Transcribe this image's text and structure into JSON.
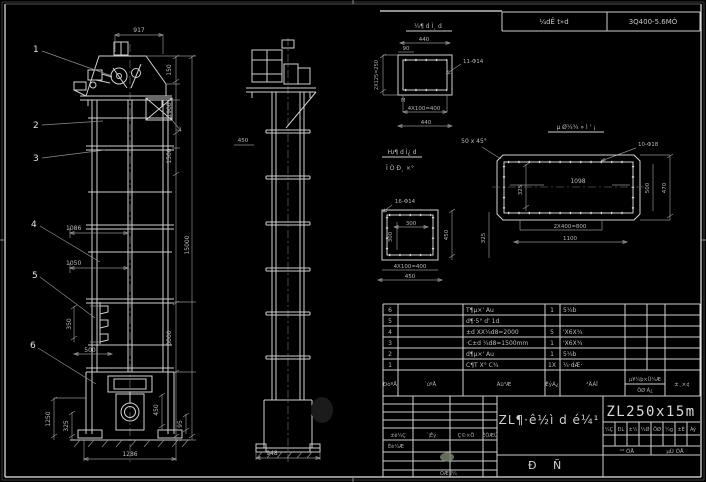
{
  "colors": {
    "background": "#000000",
    "line": "#cfcfcf",
    "dim_text": "#aeaeae",
    "stamp": "#76806b"
  },
  "frame": {
    "band_left": "¼dÊ t»d",
    "band_right": "3Q400-5.6MÓ"
  },
  "front_view": {
    "balloons": [
      "1",
      "2",
      "3",
      "4",
      "5",
      "6"
    ],
    "dims": {
      "top_width": "917",
      "v150": "150",
      "v1900": "1900",
      "v1500": "1500",
      "v15000": "15000",
      "v3000": "3000",
      "v350": "350",
      "h1086": "1086",
      "h1050": "1050",
      "h500": "500",
      "v1250": "1250",
      "v325": "325",
      "v450": "450",
      "v95": "95",
      "bottom_width": "1286"
    }
  },
  "side_view": {
    "dims": {
      "d450": "450",
      "bottom_width": "948"
    }
  },
  "detail_flange": {
    "title": "¼¶ d Ì¸ d",
    "dim_440": "440",
    "dim_90": "90",
    "holes": "11-Φ14",
    "dim_2x125": "2X125=250",
    "dim_4x100": "4X100=400",
    "dim_440b": "440",
    "weld": "M"
  },
  "note_chamfer": "50 x 45°",
  "detail_square": {
    "title_top": "Ƕ¶ d Ì¿ d",
    "title_bottom": "Î Ò Ð¸ ×°",
    "holes": "16-Φ14",
    "dim_300h": "300",
    "dim_300v": "300",
    "dim_4x100": "4X100=400",
    "dim_450": "450",
    "dim_450r": "450",
    "dim_325": "325"
  },
  "detail_base": {
    "title": "µ Ø¼¾ » ì ' ¡",
    "holes": "10-Φ18",
    "dim_1098": "1098",
    "dim_325": "325",
    "dim_2x400": "2X400=800",
    "dim_1100": "1100",
    "dim_500": "500",
    "dim_470": "470"
  },
  "bom": {
    "headers": {
      "no": "ÐòºÅ",
      "code": "´úºÅ",
      "name": "Ãû³Æ",
      "qty": "ÊýÁ¿",
      "mat": "²ÄÁÏ",
      "weight_top": "µ¥¼þ×Ü¼Æ",
      "weight_bottom": "ÖØ Á¿",
      "note": "±¸×¢"
    },
    "rows": [
      {
        "no": "6",
        "name": "T¶µ×' Au",
        "qty": "1",
        "mat": "5¼b"
      },
      {
        "no": "5",
        "name": "d¶·5° d' 1d",
        "qty": "",
        "mat": ""
      },
      {
        "no": "4",
        "name": "±d XX¼d8=2000",
        "qty": "5",
        "mat": "'X6X¾"
      },
      {
        "no": "3",
        "name": "·C±d ¼d8=1500mm",
        "qty": "1",
        "mat": "'X6X¾"
      },
      {
        "no": "2",
        "name": "d¶µ×' Au",
        "qty": "1",
        "mat": "5¼b"
      },
      {
        "no": "1",
        "name": "C¶T X° C¾",
        "qty": "1X",
        "mat": "¼·dÆ·"
      }
    ]
  },
  "title_block": {
    "stamp_headers": [
      "±ê¼Ç",
      "´¦Êý",
      "Ç©×Ö",
      "ÈÕÆÚ"
    ],
    "row_label_design": "Éè¼Æ",
    "row_label_check": "ÖÆ Í¼",
    "main_title": "ZL¶·ê½ì d é¼¹",
    "chars": [
      "Ð",
      "Ñ"
    ],
    "model": "ZL250x15m",
    "small_cells": [
      "¼Ç",
      "ÐL",
      "±¼",
      "¼Ø",
      "ÖØ",
      "¼g",
      "±È",
      "Àý"
    ],
    "sheet_total": "¹² ÕÅ",
    "sheet_no": "µÚ ÕÅ"
  }
}
